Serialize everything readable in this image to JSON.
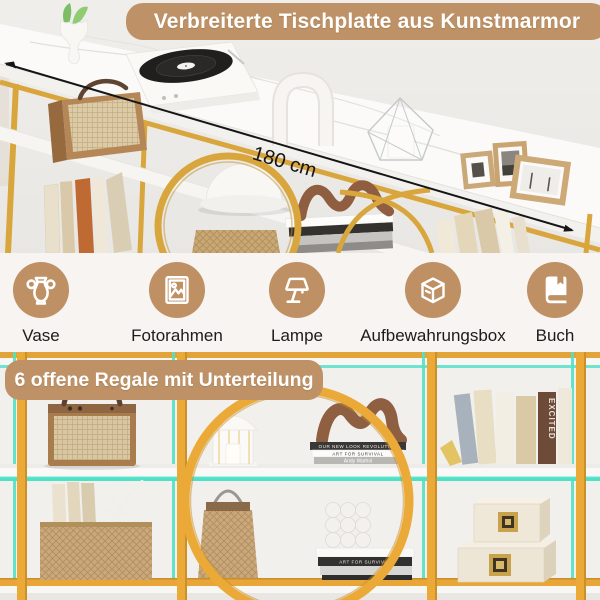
{
  "top_section": {
    "banner_label": "Verbreiterte Tischplatte aus Kunstmarmor",
    "dimension_label": "180 cm"
  },
  "features": {
    "items": [
      {
        "icon": "vase-icon",
        "label": "Vase"
      },
      {
        "icon": "photo-frame-icon",
        "label": "Fotorahmen"
      },
      {
        "icon": "lamp-icon",
        "label": "Lampe"
      },
      {
        "icon": "storage-box-icon",
        "label": "Aufbewahrungsbox"
      },
      {
        "icon": "book-icon",
        "label": "Buch"
      }
    ]
  },
  "bottom_section": {
    "banner_label": "6 offene Regale mit Unterteilung",
    "decor_text": {
      "shelf_book_1": "OUR NEW LOOK REVOLUTION",
      "shelf_book_2": "ART FOR SURVIVAL",
      "shelf_book_3": "Andy Warhol",
      "lower_book_1": "ART FOR SURVIVAL",
      "standing_book": "EXCITED"
    }
  },
  "colors": {
    "banner_tan": "#BE9266",
    "icon_circle_tan": "#BE9063",
    "banner_text": "#FFFFFF",
    "label_text": "#1C1C1C",
    "gold_frame": "#D8A63C",
    "gold_frame_bright": "#EBAA38",
    "teal_shelf_glow": "#53E0C6",
    "marble_white": "#FAFAF8",
    "arrow_black": "#151515"
  }
}
